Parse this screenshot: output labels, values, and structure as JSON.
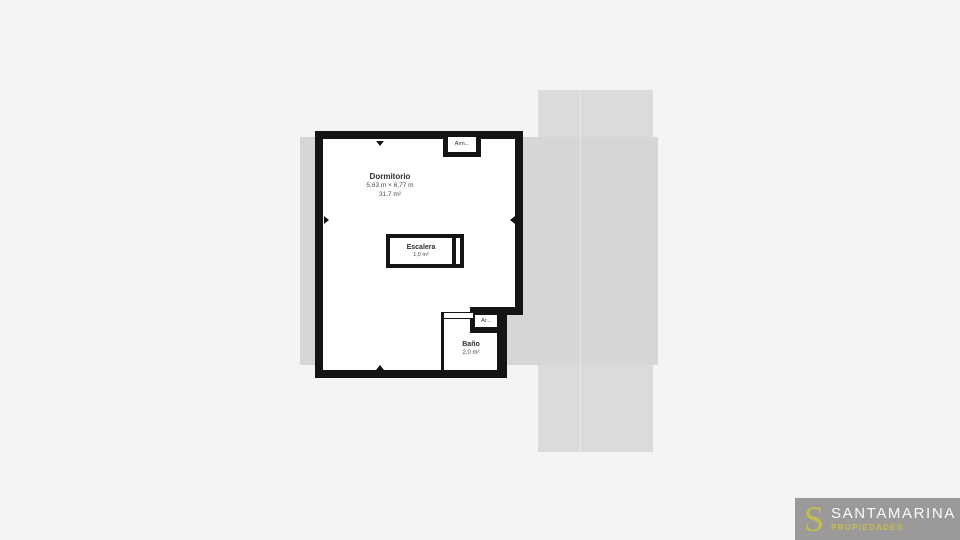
{
  "canvas": {
    "bg_color": "#f5f4f2",
    "silhouette_color": "#d6d6d5",
    "panel_color": "#dbdbda"
  },
  "floorplan": {
    "wall_color": "#141414",
    "rooms": {
      "dormitorio": {
        "name": "Dormitorio",
        "dims": "5,63 m × 6,77 m",
        "area": "31,7 m²"
      },
      "escalera": {
        "name": "Escalera",
        "area": "1,0 m²"
      },
      "bano": {
        "name": "Baño",
        "area": "2,0 m²"
      },
      "armario_top": {
        "name": "Arm..."
      },
      "armario_bottom": {
        "name": "Ar..."
      }
    }
  },
  "logo": {
    "monogram": "S",
    "brand": "SANTAMARINA",
    "tagline": "PROPIEDADES",
    "bg_color": "#9b9a98",
    "accent_color": "#c6bd4d"
  }
}
